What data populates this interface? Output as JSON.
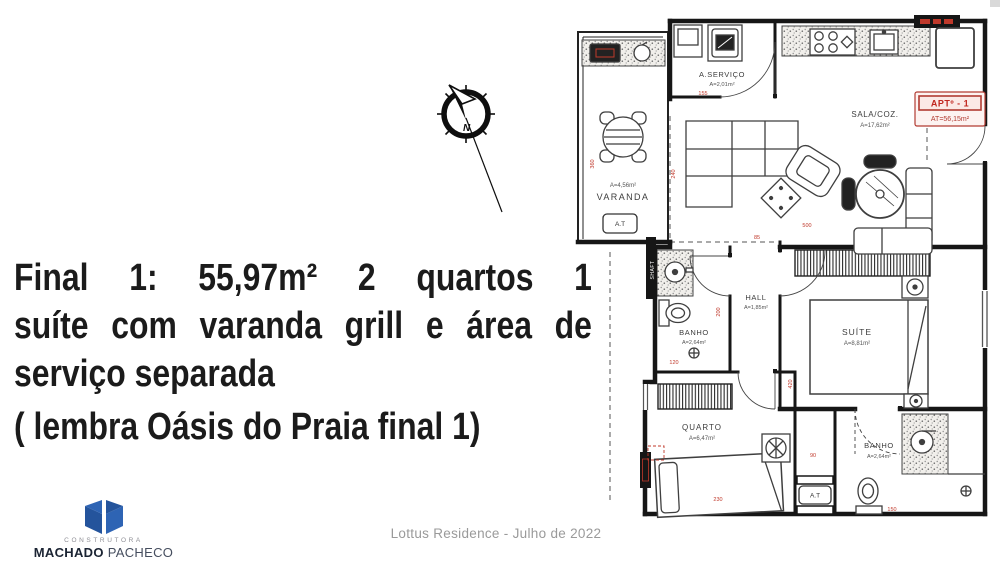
{
  "headline": {
    "line1": "Final 1: 55,97m² 2 quartos 1",
    "line2": "suíte com varanda grill e área de",
    "line3": "serviço separada",
    "note": "( lembra Oásis do Praia final 1)"
  },
  "compass": {
    "label": "N"
  },
  "footer": {
    "caption": "Lottus Residence - Julho de 2022"
  },
  "logo": {
    "tagline": "CONSTRUTORA",
    "name_bold": "MACHADO",
    "name_regular": "PACHECO"
  },
  "floorplan": {
    "badge": {
      "title": "APTº - 1",
      "area": "AT=56,15m²"
    },
    "rooms": {
      "servico": {
        "name": "A.SERVIÇO",
        "area": "A=2,01m²"
      },
      "sala": {
        "name": "SALA/COZ.",
        "area": "A=17,62m²"
      },
      "varanda": {
        "name": "VARANDA",
        "area": "A=4,56m²"
      },
      "hall": {
        "name": "HALL",
        "area": "A=1,85m²"
      },
      "banho1": {
        "name": "BANHO",
        "area": "A=2,64m²"
      },
      "suite": {
        "name": "SUÍTE",
        "area": "A=8,81m²"
      },
      "quarto": {
        "name": "QUARTO",
        "area": "A=6,47m²"
      },
      "banho2": {
        "name": "BANHO",
        "area": "A=2,64m²"
      }
    },
    "labels": {
      "at1": "A.T",
      "at2": "A.T",
      "shaft": "SHAFT"
    },
    "dimensions": {
      "d155": "155",
      "d360": "360",
      "d240": "240",
      "d85": "85",
      "d500": "500",
      "d200": "200",
      "d120": "120",
      "d230": "230",
      "d420": "420",
      "d90": "90",
      "d150": "150"
    },
    "colors": {
      "dimension_red": "#c0392b",
      "wall_black": "#161616"
    }
  }
}
